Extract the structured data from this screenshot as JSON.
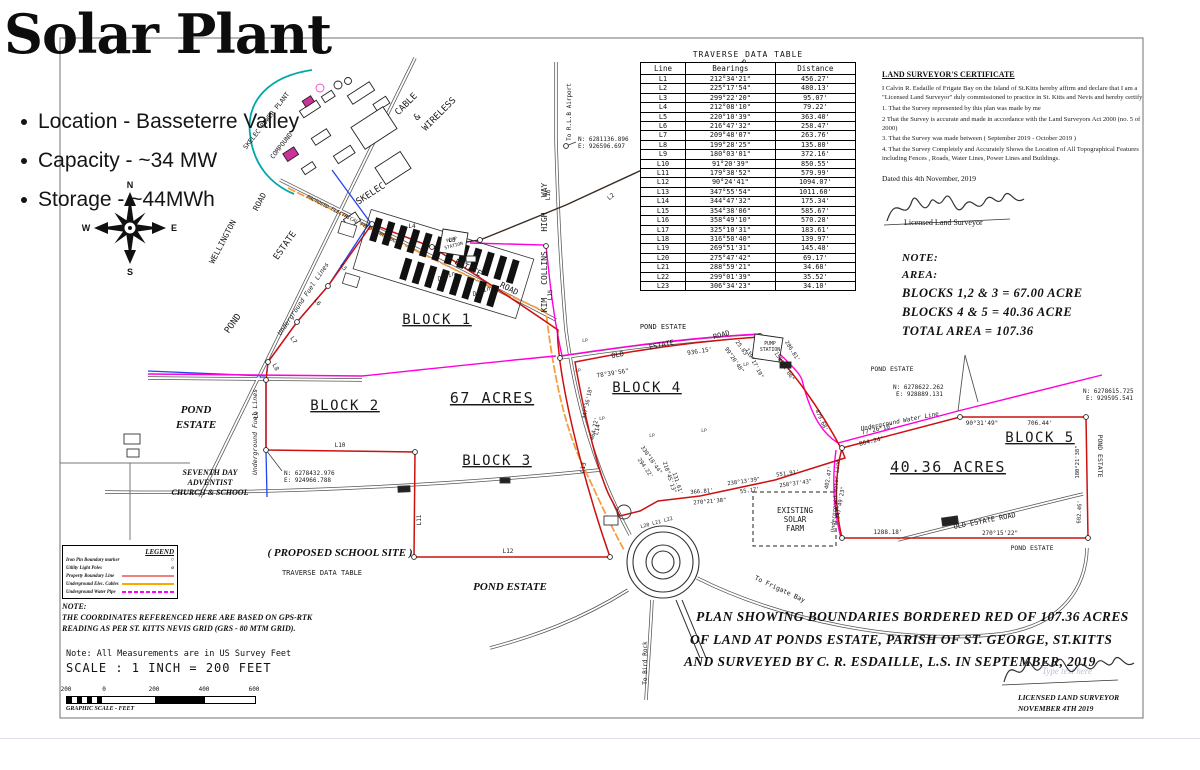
{
  "header": {
    "title": "Solar Plant",
    "bullets": [
      "Location - Basseterre Valley",
      "Capacity - ~34 MW",
      "Storage - ~44MWh"
    ]
  },
  "compass": {
    "n": "N",
    "s": "S",
    "e": "E",
    "w": "W"
  },
  "traverse_table": {
    "title": "TRAVERSE DATA TABLE",
    "columns": [
      "Line",
      "Bearings",
      "Distance"
    ],
    "rows": [
      [
        "L1",
        "212°34'21\"",
        "456.27'"
      ],
      [
        "L2",
        "225°17'54\"",
        "480.13'"
      ],
      [
        "L3",
        "299°22'20\"",
        "95.07'"
      ],
      [
        "L4",
        "212°08'10\"",
        "79.22'"
      ],
      [
        "L5",
        "220°10'39\"",
        "363.40'"
      ],
      [
        "L6",
        "216°47'32\"",
        "258.47'"
      ],
      [
        "L7",
        "209°48'07\"",
        "263.76'"
      ],
      [
        "L8",
        "199°28'25\"",
        "135.80'"
      ],
      [
        "L9",
        "180°03'01\"",
        "372.16'"
      ],
      [
        "L10",
        "91°20'39\"",
        "850.55'"
      ],
      [
        "L11",
        "179°38'52\"",
        "579.99'"
      ],
      [
        "L12",
        "90°24'41\"",
        "1094.07'"
      ],
      [
        "L13",
        "347°55'54\"",
        "1011.60'"
      ],
      [
        "L14",
        "344°47'32\"",
        "175.34'"
      ],
      [
        "L15",
        "354°38'06\"",
        "585.67'"
      ],
      [
        "L16",
        "358°49'10\"",
        "570.28'"
      ],
      [
        "L17",
        "325°10'31\"",
        "183.61'"
      ],
      [
        "L18",
        "316°50'40\"",
        "139.97'"
      ],
      [
        "L19",
        "269°51'31\"",
        "145.48'"
      ],
      [
        "L20",
        "275°47'42\"",
        "69.17'"
      ],
      [
        "L21",
        "288°59'21\"",
        "34.68'"
      ],
      [
        "L22",
        "299°01'39\"",
        "35.52'"
      ],
      [
        "L23",
        "306°34'23\"",
        "34.10'"
      ]
    ]
  },
  "certificate": {
    "heading": "LAND SURVEYOR'S CERTIFICATE",
    "body": [
      "I Calvin R. Esdaille of Frigate Bay on the Island of St.Kitts hereby affirm and declare that I am a \"Licensed Land Surveyor\" duly commissioned to practice in St. Kitts and Nevis and hereby certify",
      "1. That the Survey represented by this plan was made by me",
      "2 That the Survey is accurate and made in accordance with the Land Surveyors Act 2000 (no. 5 of 2000)",
      "3. That the Survey was made between ( September 2019 - October 2019 )",
      "4. That the Survey Completely and Accurately Shows the Location of All Topographical Features including Fences , Roads, Water Lines, Power Lines and Buildings."
    ],
    "dated": "Dated this 4th November, 2019",
    "signature_caption": "Licensed Land Surveyor"
  },
  "note_area": {
    "lines": [
      "NOTE:",
      "AREA:",
      "BLOCKS 1,2 & 3 = 67.00 ACRE",
      "BLOCKS 4 & 5 = 40.36 ACRE",
      "TOTAL AREA = 107.36"
    ]
  },
  "caption": {
    "lines": [
      "PLAN SHOWING BOUNDARIES BORDERED RED OF 107.36 ACRES",
      "OF LAND AT PONDS ESTATE, PARISH OF ST. GEORGE, ST.KITTS",
      "AND SURVEYED BY C. R. ESDAILLE, L.S. IN SEPTEMBER, 2019"
    ]
  },
  "legend": {
    "title": "LEGEND",
    "items": [
      {
        "label": "Iron Pin Boundary marker",
        "sym": "circle"
      },
      {
        "label": "Utility Light Poles",
        "sym": "pole"
      },
      {
        "label": "Property Boundary Line",
        "sym": "line",
        "color": "#f08080",
        "dashed": false
      },
      {
        "label": "Underground Elec. Cables",
        "sym": "line",
        "color": "#ffa500",
        "dashed": false
      },
      {
        "label": "Underground Water Pipe",
        "sym": "line",
        "color": "#ff00ff",
        "dashed": true
      }
    ]
  },
  "notes": {
    "gps": [
      "NOTE:",
      "THE COORDINATES REFERENCED HERE ARE BASED ON GPS-RTK",
      "READING AS PER ST. KITTS NEVIS GRID (GRS - 80 MTM GRID)."
    ],
    "measurements": "Note: All Measurements are in US Survey Feet",
    "scale": "SCALE : 1 INCH = 200 FEET"
  },
  "scale_bar": {
    "ticks": [
      [
        "200",
        0
      ],
      [
        "0",
        38
      ],
      [
        "200",
        88
      ],
      [
        "400",
        138
      ],
      [
        "600",
        188
      ]
    ],
    "caption": "GRAPHIC SCALE - FEET"
  },
  "stamp": {
    "line1": "LICENSED LAND SURVEYOR",
    "line2": "NOVEMBER 4TH 2019",
    "watermark": "Type text here"
  },
  "colors": {
    "boundary_red": "#cc1111",
    "water_magenta": "#ff00dd",
    "electrical_orange": "#f5a040",
    "fuel_blue": "#2244ee",
    "compound_teal": "#00a8a8",
    "building_pink": "#cc3399"
  },
  "map": {
    "labels": [
      [
        "SKELEC POWER PLANT",
        268,
        122,
        -52,
        6.5,
        "d"
      ],
      [
        "COMPOUND",
        283,
        147,
        -52,
        6.5,
        "d"
      ],
      [
        "CABLE",
        408,
        106,
        -45,
        9,
        "d"
      ],
      [
        "&",
        419,
        119,
        -45,
        9,
        "d"
      ],
      [
        "WIRELESS",
        441,
        116,
        -45,
        9,
        "d"
      ],
      [
        "SKELEC",
        372,
        196,
        -33,
        9,
        "d"
      ],
      [
        "ROAD",
        262,
        203,
        -62,
        8,
        "d"
      ],
      [
        "WELLINGTON",
        225,
        243,
        -62,
        8,
        "d"
      ],
      [
        "ESTATE",
        287,
        247,
        -55,
        9,
        "d"
      ],
      [
        "POND",
        235,
        325,
        -55,
        9,
        "d"
      ],
      [
        "ESTATE",
        467,
        270,
        27,
        8,
        "d"
      ],
      [
        "ROAD",
        508,
        291,
        27,
        8,
        "d"
      ],
      [
        "PROPOSED ELECTRICAL FEED LINE (UG)",
        352,
        221,
        27,
        5,
        "di"
      ],
      [
        "To R.L.B Airport",
        571,
        112,
        -90,
        6,
        "d"
      ],
      [
        "WAY",
        547,
        190,
        -90,
        8,
        "d"
      ],
      [
        "HIGH",
        547,
        222,
        -90,
        8,
        "d"
      ],
      [
        "COLLINS",
        547,
        268,
        -90,
        8,
        "d"
      ],
      [
        "KIM",
        547,
        305,
        -90,
        8,
        "d"
      ],
      [
        "ROAD",
        747,
        68,
        38,
        7,
        "d"
      ],
      [
        "ESTATE",
        766,
        88,
        38,
        7,
        "d"
      ],
      [
        "BLOCK 1",
        437,
        324,
        0,
        14,
        "u"
      ],
      [
        "BLOCK 2",
        345,
        410,
        0,
        14,
        "u"
      ],
      [
        "BLOCK 3",
        497,
        465,
        0,
        14,
        "u"
      ],
      [
        "BLOCK 4",
        647,
        392,
        0,
        14,
        "u"
      ],
      [
        "BLOCK 5",
        1040,
        442,
        0,
        14,
        "u"
      ],
      [
        "67 ACRES",
        492,
        403,
        0,
        15,
        "u"
      ],
      [
        "40.36 ACRES",
        948,
        472,
        0,
        15,
        "u"
      ],
      [
        "POND",
        196,
        413,
        0,
        11,
        "s"
      ],
      [
        "ESTATE",
        196,
        428,
        0,
        11,
        "s"
      ],
      [
        "SEVENTH DAY",
        210,
        475,
        0,
        8,
        "s"
      ],
      [
        "ADVENTIST",
        210,
        485,
        0,
        8,
        "s"
      ],
      [
        "CHURCH & SCHOOL",
        210,
        495,
        0,
        8,
        "s"
      ],
      [
        "POND ESTATE",
        510,
        590,
        0,
        11,
        "s"
      ],
      [
        "( PROPOSED SCHOOL SITE )",
        340,
        556,
        0,
        11,
        "s"
      ],
      [
        "TRAVERSE DATA TABLE",
        322,
        575,
        0,
        7,
        "d"
      ],
      [
        "POND ESTATE",
        663,
        329,
        0,
        7,
        "d"
      ],
      [
        "OLD",
        618,
        357,
        -10,
        7,
        "d"
      ],
      [
        "ESTATE",
        662,
        347,
        -12,
        7,
        "d"
      ],
      [
        "ROAD",
        722,
        337,
        -15,
        7,
        "d"
      ],
      [
        "POND ESTATE",
        892,
        371,
        0,
        6.5,
        "d"
      ],
      [
        "POND ESTATE",
        1032,
        550,
        0,
        6.5,
        "d"
      ],
      [
        "POND ESTATE",
        1098,
        456,
        90,
        6.5,
        "d"
      ],
      [
        "OLD ESTATE ROAD",
        985,
        523,
        -11,
        7,
        "d"
      ],
      [
        "To Frigate Bay",
        779,
        591,
        25,
        6.5,
        "d"
      ],
      [
        "To Bird Rock",
        647,
        663,
        -90,
        6,
        "d"
      ],
      [
        "EXISTING",
        795,
        513,
        0,
        7.5,
        "d"
      ],
      [
        "SOLAR",
        795,
        522,
        0,
        7.5,
        "d"
      ],
      [
        "FARM",
        795,
        531,
        0,
        7.5,
        "d"
      ],
      [
        "PUMP",
        770,
        345,
        0,
        4.8,
        "d"
      ],
      [
        "STATION",
        770,
        351,
        0,
        4.8,
        "d"
      ],
      [
        "PUMP",
        452,
        241,
        -15,
        4.5,
        "d"
      ],
      [
        "STATION",
        454,
        247,
        -15,
        4.5,
        "d"
      ],
      [
        "Drain",
        447,
        278,
        -20,
        6,
        "di"
      ],
      [
        "Drain",
        482,
        293,
        -20,
        6,
        "di"
      ],
      [
        "Underground Fuel Lines",
        305,
        300,
        -56,
        6.5,
        "di"
      ],
      [
        "Underground Fuel Lines",
        257,
        432,
        -90,
        6.5,
        "di"
      ],
      [
        "Underground Water Line",
        900,
        423,
        -11,
        6,
        "di"
      ],
      [
        "Underground Water Line",
        837,
        496,
        -86,
        5.5,
        "di"
      ],
      [
        "N: 6281136.896",
        578,
        141,
        0,
        6,
        "dl"
      ],
      [
        "E: 926596.697",
        578,
        148,
        0,
        6,
        "dl"
      ],
      [
        "N: 6278432.976",
        284,
        475,
        0,
        6,
        "dl"
      ],
      [
        "E: 924966.788",
        284,
        482,
        0,
        6,
        "dl"
      ],
      [
        "N: 6278622.262",
        893,
        389,
        0,
        6,
        "dl"
      ],
      [
        "E: 928889.131",
        896,
        396,
        0,
        6,
        "dl"
      ],
      [
        "N: 6278615.725",
        1083,
        393,
        0,
        6,
        "dl"
      ],
      [
        "E: 929595.541",
        1086,
        400,
        0,
        6,
        "dl"
      ],
      [
        "L19",
        761,
        82,
        0,
        6,
        "d"
      ],
      [
        "L1",
        699,
        129,
        -42,
        6,
        "d"
      ],
      [
        "L2",
        612,
        198,
        -40,
        6,
        "d"
      ],
      [
        "L3",
        452,
        242,
        0,
        6,
        "d"
      ],
      [
        "L4",
        412,
        228,
        0,
        6,
        "d"
      ],
      [
        "L5",
        342,
        268,
        58,
        6,
        "d"
      ],
      [
        "L6",
        316,
        303,
        56,
        6,
        "d"
      ],
      [
        "L7",
        292,
        341,
        56,
        6,
        "d"
      ],
      [
        "L8",
        274,
        368,
        62,
        6,
        "d"
      ],
      [
        "L9",
        258,
        415,
        -90,
        6,
        "d"
      ],
      [
        "L10",
        340,
        447,
        0,
        6,
        "d"
      ],
      [
        "L11",
        421,
        520,
        -90,
        6,
        "d"
      ],
      [
        "L12",
        508,
        553,
        0,
        6,
        "d"
      ],
      [
        "L13",
        585,
        468,
        -80,
        6,
        "d"
      ],
      [
        "L14",
        599,
        430,
        -78,
        6,
        "d"
      ],
      [
        "L15",
        552,
        295,
        -88,
        6,
        "d"
      ],
      [
        "L16",
        550,
        195,
        -88,
        6,
        "d"
      ],
      [
        "936.15'",
        700,
        353,
        -9,
        6,
        "d"
      ],
      [
        "78°39'56\"",
        613,
        375,
        -9,
        6,
        "d"
      ],
      [
        "25.83'",
        741,
        350,
        55,
        5.5,
        "d"
      ],
      [
        "99°20'48\"",
        733,
        361,
        55,
        5.5,
        "d"
      ],
      [
        "139°17'19\"",
        753,
        364,
        62,
        5.5,
        "d"
      ],
      [
        "286.81'",
        791,
        352,
        58,
        5.5,
        "d"
      ],
      [
        "158°31'06\"",
        783,
        367,
        58,
        5.5,
        "d"
      ],
      [
        "479.68'",
        820,
        421,
        65,
        5.5,
        "d"
      ],
      [
        "864.24'",
        872,
        443,
        -13,
        6,
        "d"
      ],
      [
        "77°26'10\"",
        878,
        431,
        -13,
        6,
        "d"
      ],
      [
        "90°31'49\"",
        982,
        425,
        0,
        6,
        "d"
      ],
      [
        "706.44'",
        1040,
        425,
        0,
        6,
        "d"
      ],
      [
        "180°21'38\"",
        1079,
        462,
        -90,
        5.5,
        "d"
      ],
      [
        "602.46'",
        1081,
        512,
        -87,
        5.5,
        "d"
      ],
      [
        "270°15'22\"",
        1000,
        535,
        0,
        6,
        "d"
      ],
      [
        "1288.18'",
        888,
        534,
        0,
        6,
        "d"
      ],
      [
        "402.47'",
        830,
        478,
        -80,
        5.5,
        "d"
      ],
      [
        "347°49'23\"",
        842,
        503,
        -80,
        5.5,
        "d"
      ],
      [
        "366.81'",
        702,
        493,
        -5,
        5.5,
        "d"
      ],
      [
        "270°21'38\"",
        710,
        503,
        -5,
        5.5,
        "d"
      ],
      [
        "238°13'39\"",
        744,
        483,
        -8,
        5.5,
        "d"
      ],
      [
        "55.17'",
        750,
        492,
        -8,
        5.5,
        "d"
      ],
      [
        "551.91'",
        788,
        475,
        -8,
        5.5,
        "d"
      ],
      [
        "258°37'43\"",
        796,
        485,
        -8,
        5.5,
        "d"
      ],
      [
        "347°36'18\"",
        589,
        403,
        -78,
        5.5,
        "d"
      ],
      [
        "464.72'",
        596,
        429,
        -78,
        5.5,
        "d"
      ],
      [
        "330°18'44\"",
        650,
        461,
        55,
        5.5,
        "d"
      ],
      [
        "294.22'",
        644,
        469,
        55,
        5.5,
        "d"
      ],
      [
        "218°45'13\"",
        668,
        478,
        72,
        5.5,
        "d"
      ],
      [
        "131.61'",
        676,
        484,
        72,
        5.5,
        "d"
      ],
      [
        "L20 L21 L22",
        657,
        524,
        -15,
        5,
        "d"
      ],
      [
        "LP",
        585,
        342,
        0,
        4.5,
        "lp"
      ],
      [
        "LP",
        578,
        372,
        0,
        4.5,
        "lp"
      ],
      [
        "LP",
        602,
        420,
        0,
        4.5,
        "lp"
      ],
      [
        "LP",
        652,
        437,
        0,
        4.5,
        "lp"
      ],
      [
        "LP",
        704,
        432,
        0,
        4.5,
        "lp"
      ],
      [
        "LP",
        746,
        366,
        0,
        4.5,
        "lp"
      ]
    ]
  }
}
